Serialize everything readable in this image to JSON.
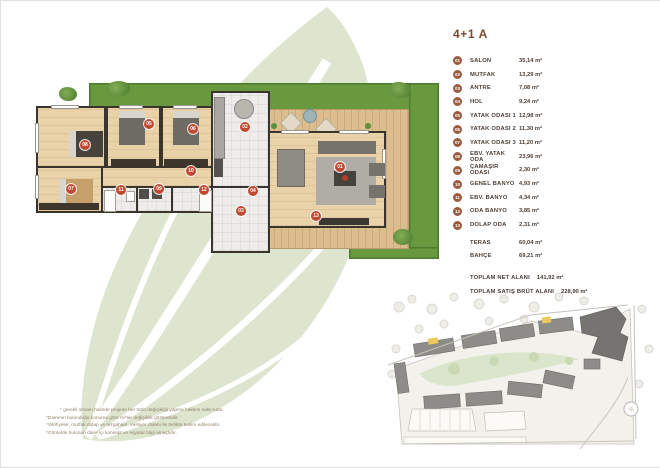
{
  "page": {
    "title": "4+1 A"
  },
  "colors": {
    "accent_brown": "#9a5b40",
    "title_brown": "#7c4b2f",
    "plan_marker_red": "#c04a31",
    "lawn_green": "#68993f",
    "leaf_watermark": "#dde5cf"
  },
  "legend": {
    "items": [
      {
        "num": "01",
        "label": "SALON",
        "value": "35,14 m²"
      },
      {
        "num": "02",
        "label": "MUTFAK",
        "value": "13,29 m²"
      },
      {
        "num": "03",
        "label": "ANTRE",
        "value": "7,08 m²"
      },
      {
        "num": "04",
        "label": "HOL",
        "value": "9,24 m²"
      },
      {
        "num": "05",
        "label": "YATAK ODASI 1",
        "value": "12,98 m²"
      },
      {
        "num": "06",
        "label": "YATAK ODASI 2",
        "value": "11,30 m²"
      },
      {
        "num": "07",
        "label": "YATAK ODASI 3",
        "value": "11,20 m²"
      },
      {
        "num": "08",
        "label": "EBV. YATAK ODA",
        "value": "23,96 m²"
      },
      {
        "num": "09",
        "label": "ÇAMAŞIR ODASI",
        "value": "2,30 m²"
      },
      {
        "num": "10",
        "label": "GENEL BANYO",
        "value": "4,93 m²"
      },
      {
        "num": "11",
        "label": "EBV. BANYO",
        "value": "4,34 m²"
      },
      {
        "num": "12",
        "label": "ODA BANYO",
        "value": "3,85 m²"
      },
      {
        "num": "13",
        "label": "DOLAP ODA",
        "value": "2,31 m²"
      }
    ],
    "extras": [
      {
        "label": "TERAS",
        "value": "60,04 m²"
      },
      {
        "label": "BAHÇE",
        "value": "69,21 m²"
      }
    ],
    "totals": [
      {
        "label": "TOPLAM NET ALANI",
        "value": "141,92 m²"
      },
      {
        "label": "TOPLAM SATIŞ BRÜT ALANI",
        "value": "228,90 m²"
      }
    ]
  },
  "plan_markers": [
    {
      "num": "01"
    },
    {
      "num": "02"
    },
    {
      "num": "03"
    },
    {
      "num": "04"
    },
    {
      "num": "05"
    },
    {
      "num": "06"
    },
    {
      "num": "07"
    },
    {
      "num": "08"
    },
    {
      "num": "09"
    },
    {
      "num": "10"
    },
    {
      "num": "11"
    },
    {
      "num": "12"
    },
    {
      "num": "13"
    }
  ],
  "footnotes": {
    "line1": "* gerekli olması halinde projede her türlü değişikliği yapma hakkını saklı tutar.",
    "line2": "*Dairenin bulunduğu konuma göre m²'ler değişiklik gösterebilir.",
    "line3": "*Vitrifiyeler, mutfak dolap ve tezgahları, vestiyer dolabı ile birlikte teslim edilecektir.",
    "line4": "*Görselde bulunan daire içi konsept ve eşyalar bilgi amaçlıdır."
  }
}
